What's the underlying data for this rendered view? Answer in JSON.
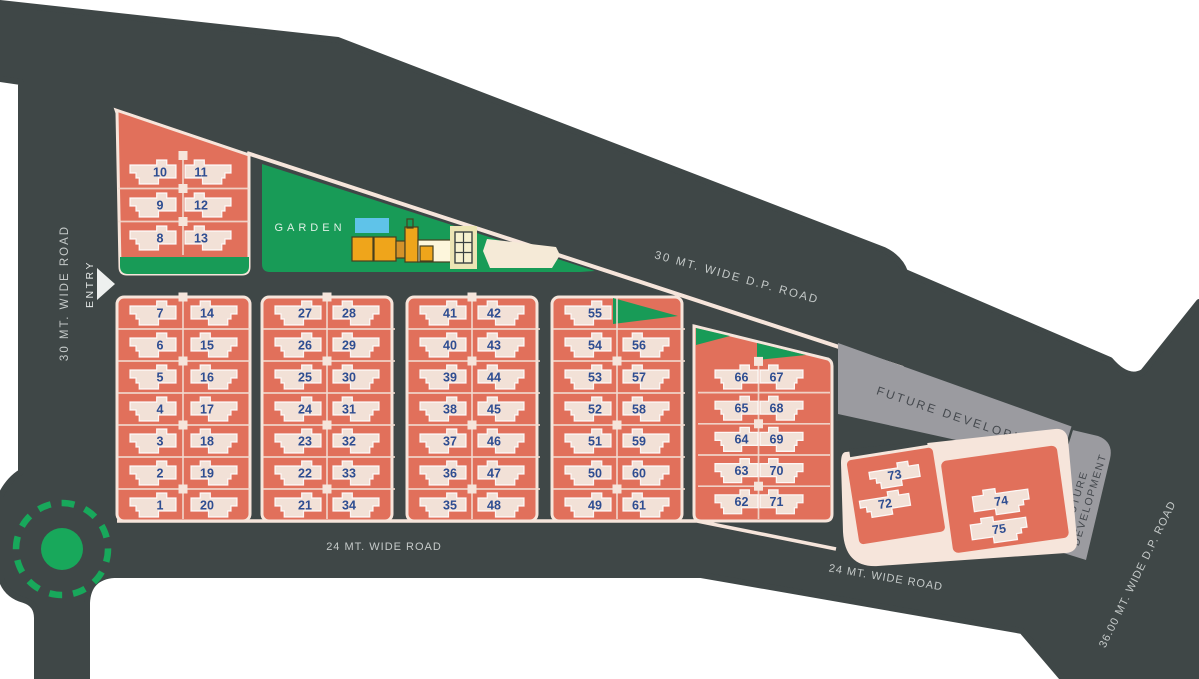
{
  "title": "Site Layout Plan",
  "colors": {
    "road_base": "#3f4747",
    "plot_block": "#e1705b",
    "block_outline": "#f6e5db",
    "house": "#f2e1d7",
    "plot_number": "#2e4d91",
    "green": "#189b57",
    "future_development": "#9b9ba0",
    "pool": "#5fc3e9",
    "clubhouse": "#efa51b",
    "road_text": "#c5cac9"
  },
  "labels": {
    "garden": "GARDEN",
    "entry": "ENTRY",
    "road_left": "30 MT. WIDE ROAD",
    "road_top": "30 MT. WIDE D.P. ROAD",
    "road_bottom": "24 MT. WIDE ROAD",
    "road_bottom_right": "24 MT. WIDE ROAD",
    "road_right": "36.00 MT. WIDE D.P. ROAD",
    "future_1": "FUTURE DEVELOPMENT",
    "future_2_line1": "FUTURE",
    "future_2_line2": "DEVELOPMENT"
  },
  "blocks": [
    {
      "id": "block-a",
      "rows": [
        [
          "10",
          "11"
        ],
        [
          "9",
          "12"
        ],
        [
          "8",
          "13"
        ]
      ]
    },
    {
      "id": "block-b",
      "rows": [
        [
          "7",
          "14"
        ],
        [
          "6",
          "15"
        ],
        [
          "5",
          "16"
        ],
        [
          "4",
          "17"
        ],
        [
          "3",
          "18"
        ],
        [
          "2",
          "19"
        ],
        [
          "1",
          "20"
        ]
      ]
    },
    {
      "id": "block-c",
      "rows": [
        [
          "27",
          "28"
        ],
        [
          "26",
          "29"
        ],
        [
          "25",
          "30"
        ],
        [
          "24",
          "31"
        ],
        [
          "23",
          "32"
        ],
        [
          "22",
          "33"
        ],
        [
          "21",
          "34"
        ]
      ]
    },
    {
      "id": "block-d",
      "rows": [
        [
          "41",
          "42"
        ],
        [
          "40",
          "43"
        ],
        [
          "39",
          "44"
        ],
        [
          "38",
          "45"
        ],
        [
          "37",
          "46"
        ],
        [
          "36",
          "47"
        ],
        [
          "35",
          "48"
        ]
      ]
    },
    {
      "id": "block-e",
      "rows": [
        [
          "55",
          null
        ],
        [
          "54",
          "56"
        ],
        [
          "53",
          "57"
        ],
        [
          "52",
          "58"
        ],
        [
          "51",
          "59"
        ],
        [
          "50",
          "60"
        ],
        [
          "49",
          "61"
        ]
      ]
    },
    {
      "id": "block-f",
      "rows": [
        [
          "66",
          "67"
        ],
        [
          "65",
          "68"
        ],
        [
          "64",
          "69"
        ],
        [
          "63",
          "70"
        ],
        [
          "62",
          "71"
        ]
      ]
    },
    {
      "id": "block-g",
      "rows": [
        [
          "73"
        ],
        [
          "72"
        ]
      ]
    },
    {
      "id": "block-h",
      "rows": [
        [
          "74"
        ],
        [
          "75"
        ]
      ]
    }
  ]
}
